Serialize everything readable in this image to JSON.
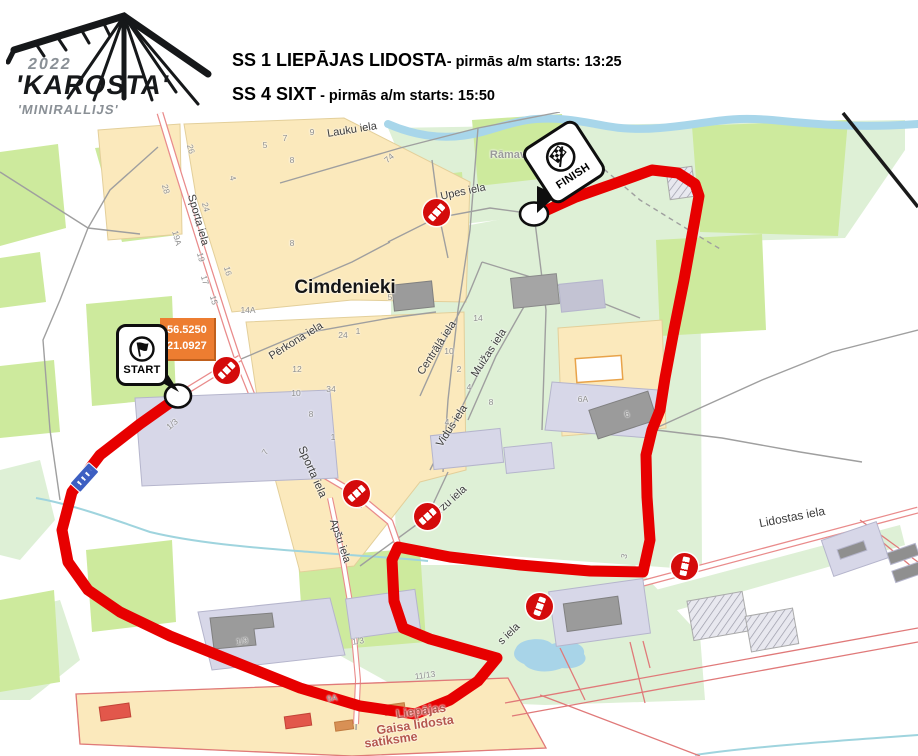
{
  "header": {
    "logo": {
      "year": "2022",
      "name": "'KAROSTA'",
      "subtitle": "'MINIRALLIJS'"
    },
    "stages": [
      {
        "name": "SS 1 LIEPĀJAS LIDOSTA",
        "info": "- pirmās a/m starts: 13:25"
      },
      {
        "name": "SS 4 SIXT",
        "info": " - pirmās a/m starts: 15:50"
      }
    ]
  },
  "map": {
    "markers": {
      "start": {
        "label": "START",
        "coordinates": [
          "56.5250",
          "21.0927"
        ]
      },
      "finish": {
        "label": "FINISH"
      }
    },
    "place_labels": [
      {
        "t": "Cimdenieki",
        "x": 345,
        "y": 288,
        "r": 0,
        "s": 19,
        "c": "#151515"
      },
      {
        "t": "Rāmava",
        "x": 511,
        "y": 155,
        "r": 0,
        "s": 11,
        "c": "#9a9a9a"
      },
      {
        "t": "Liepājas",
        "x": 421,
        "y": 711,
        "r": -8,
        "s": 12.5,
        "c": "#b5574d"
      },
      {
        "t": "Gaisa lidosta",
        "x": 415,
        "y": 725,
        "r": -8,
        "s": 12.5,
        "c": "#b5574d"
      },
      {
        "t": "satiksme",
        "x": 391,
        "y": 740,
        "r": -8,
        "s": 12.5,
        "c": "#b5574d"
      }
    ],
    "street_labels": [
      {
        "t": "Lauku iela",
        "x": 352,
        "y": 130,
        "r": -9,
        "s": 11
      },
      {
        "t": "Upes iela",
        "x": 463,
        "y": 192,
        "r": -12,
        "s": 11
      },
      {
        "t": "Sporta iela",
        "x": 198,
        "y": 220,
        "r": 74,
        "s": 11
      },
      {
        "t": "Sporta iela",
        "x": 312,
        "y": 472,
        "r": 66,
        "s": 11.5
      },
      {
        "t": "Pērkona iela",
        "x": 296,
        "y": 341,
        "r": -32,
        "s": 11
      },
      {
        "t": "Centrālā iela",
        "x": 437,
        "y": 348,
        "r": -57,
        "s": 11
      },
      {
        "t": "Muižas iela",
        "x": 489,
        "y": 353,
        "r": -57,
        "s": 11
      },
      {
        "t": "Vidus iela",
        "x": 452,
        "y": 426,
        "r": -57,
        "s": 11
      },
      {
        "t": "Bērzu iela",
        "x": 447,
        "y": 504,
        "r": -42,
        "s": 11
      },
      {
        "t": "Apšu iela",
        "x": 340,
        "y": 541,
        "r": 71,
        "s": 11
      },
      {
        "t": "Lidostas iela",
        "x": 792,
        "y": 517,
        "r": -11,
        "s": 12
      },
      {
        "t": "s iela",
        "x": 509,
        "y": 634,
        "r": -44,
        "s": 11
      }
    ],
    "house_numbers": [
      {
        "t": "26",
        "x": 191,
        "y": 149,
        "r": 75
      },
      {
        "t": "28",
        "x": 166,
        "y": 189,
        "r": 75
      },
      {
        "t": "24",
        "x": 206,
        "y": 207,
        "r": 75
      },
      {
        "t": "19A",
        "x": 177,
        "y": 238,
        "r": 75
      },
      {
        "t": "19",
        "x": 201,
        "y": 257,
        "r": 75
      },
      {
        "t": "16",
        "x": 228,
        "y": 271,
        "r": 75
      },
      {
        "t": "17",
        "x": 205,
        "y": 280,
        "r": 75
      },
      {
        "t": "15",
        "x": 214,
        "y": 300,
        "r": 75
      },
      {
        "t": "14A",
        "x": 248,
        "y": 310,
        "r": 0
      },
      {
        "t": "5",
        "x": 265,
        "y": 145,
        "r": 0
      },
      {
        "t": "7",
        "x": 285,
        "y": 138,
        "r": 0
      },
      {
        "t": "9",
        "x": 312,
        "y": 132,
        "r": 0
      },
      {
        "t": "8",
        "x": 292,
        "y": 160,
        "r": 0
      },
      {
        "t": "8",
        "x": 292,
        "y": 243,
        "r": 0
      },
      {
        "t": "74",
        "x": 389,
        "y": 158,
        "r": -40
      },
      {
        "t": "4",
        "x": 233,
        "y": 178,
        "r": 75
      },
      {
        "t": "1",
        "x": 358,
        "y": 331,
        "r": 0
      },
      {
        "t": "24",
        "x": 343,
        "y": 335,
        "r": 0
      },
      {
        "t": "12",
        "x": 297,
        "y": 369,
        "r": 0
      },
      {
        "t": "10",
        "x": 296,
        "y": 393,
        "r": 0
      },
      {
        "t": "8",
        "x": 311,
        "y": 414,
        "r": 0
      },
      {
        "t": "34",
        "x": 331,
        "y": 389,
        "r": 0
      },
      {
        "t": "1",
        "x": 333,
        "y": 437,
        "r": 0
      },
      {
        "t": "7",
        "x": 265,
        "y": 452,
        "r": -60
      },
      {
        "t": "1/3",
        "x": 172,
        "y": 424,
        "r": -40
      },
      {
        "t": "2",
        "x": 360,
        "y": 505,
        "r": 0
      },
      {
        "t": "5",
        "x": 390,
        "y": 297,
        "r": 0
      },
      {
        "t": "4",
        "x": 447,
        "y": 422,
        "r": 0
      },
      {
        "t": "14",
        "x": 478,
        "y": 318,
        "r": 0
      },
      {
        "t": "10",
        "x": 449,
        "y": 351,
        "r": 0
      },
      {
        "t": "2",
        "x": 459,
        "y": 369,
        "r": 0
      },
      {
        "t": "4",
        "x": 469,
        "y": 387,
        "r": 0
      },
      {
        "t": "8",
        "x": 491,
        "y": 402,
        "r": 0
      },
      {
        "t": "6A",
        "x": 583,
        "y": 399,
        "r": 0
      },
      {
        "t": "6",
        "x": 627,
        "y": 414,
        "r": -15
      },
      {
        "t": "3",
        "x": 624,
        "y": 556,
        "r": -75
      },
      {
        "t": "1/9",
        "x": 242,
        "y": 641,
        "r": -8
      },
      {
        "t": "1/3",
        "x": 358,
        "y": 641,
        "r": -8
      },
      {
        "t": "11/13",
        "x": 425,
        "y": 675,
        "r": -8
      },
      {
        "t": "9A",
        "x": 332,
        "y": 698,
        "r": -8
      }
    ],
    "no_entry_signs": [
      {
        "x": 226,
        "y": 370,
        "r": -45
      },
      {
        "x": 436,
        "y": 212,
        "r": -48
      },
      {
        "x": 356,
        "y": 493,
        "r": -42
      },
      {
        "x": 427,
        "y": 516,
        "r": -42
      },
      {
        "x": 539,
        "y": 606,
        "r": -70
      },
      {
        "x": 684,
        "y": 566,
        "r": -78
      }
    ],
    "colors": {
      "route": "#e70000",
      "forest": "#cdea9d",
      "field": "#def0d6",
      "residential": "#fbe9bc",
      "water": "#a8d4e8",
      "building": "#d7d7e8",
      "coord_box": "#ed7d31",
      "no_entry": "#d40b0b",
      "road_casing": "#e98b8b"
    }
  }
}
